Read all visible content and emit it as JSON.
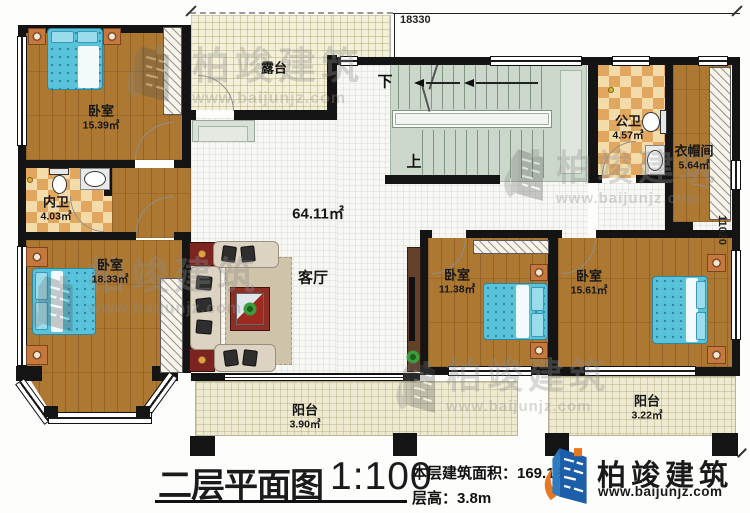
{
  "dimensions": {
    "top": "18330",
    "right": "11020"
  },
  "rooms": {
    "bedroom_tl": {
      "name": "卧室",
      "area": "15.39㎡"
    },
    "inner_bath": {
      "name": "内卫",
      "area": "4.03㎡"
    },
    "bedroom_bl": {
      "name": "卧室",
      "area": "18.33㎡"
    },
    "terrace": {
      "name": "露台",
      "area": ""
    },
    "living": {
      "name": "客厅",
      "area": "64.11㎡"
    },
    "public_bath": {
      "name": "公卫",
      "area": "4.57㎡"
    },
    "cloakroom": {
      "name": "衣帽间",
      "area": "5.64㎡"
    },
    "bedroom_bm": {
      "name": "卧室",
      "area": "11.38㎡"
    },
    "bedroom_br": {
      "name": "卧室",
      "area": "15.61㎡"
    },
    "balcony_left": {
      "name": "阳台",
      "area": "3.90㎡"
    },
    "balcony_right": {
      "name": "阳台",
      "area": "3.22㎡"
    }
  },
  "stairs": {
    "up": "上",
    "down": "下"
  },
  "footer": {
    "title": "二层平面图",
    "scale": "1:100",
    "area_line": "本层建筑面积：169.12㎡",
    "height_line": "层高：3.8m"
  },
  "brand": {
    "name": "柏竣建筑",
    "url": "www.baijunjz.com"
  },
  "watermark": {
    "name": "柏竣建筑",
    "url": "www.baijunjz.com"
  }
}
